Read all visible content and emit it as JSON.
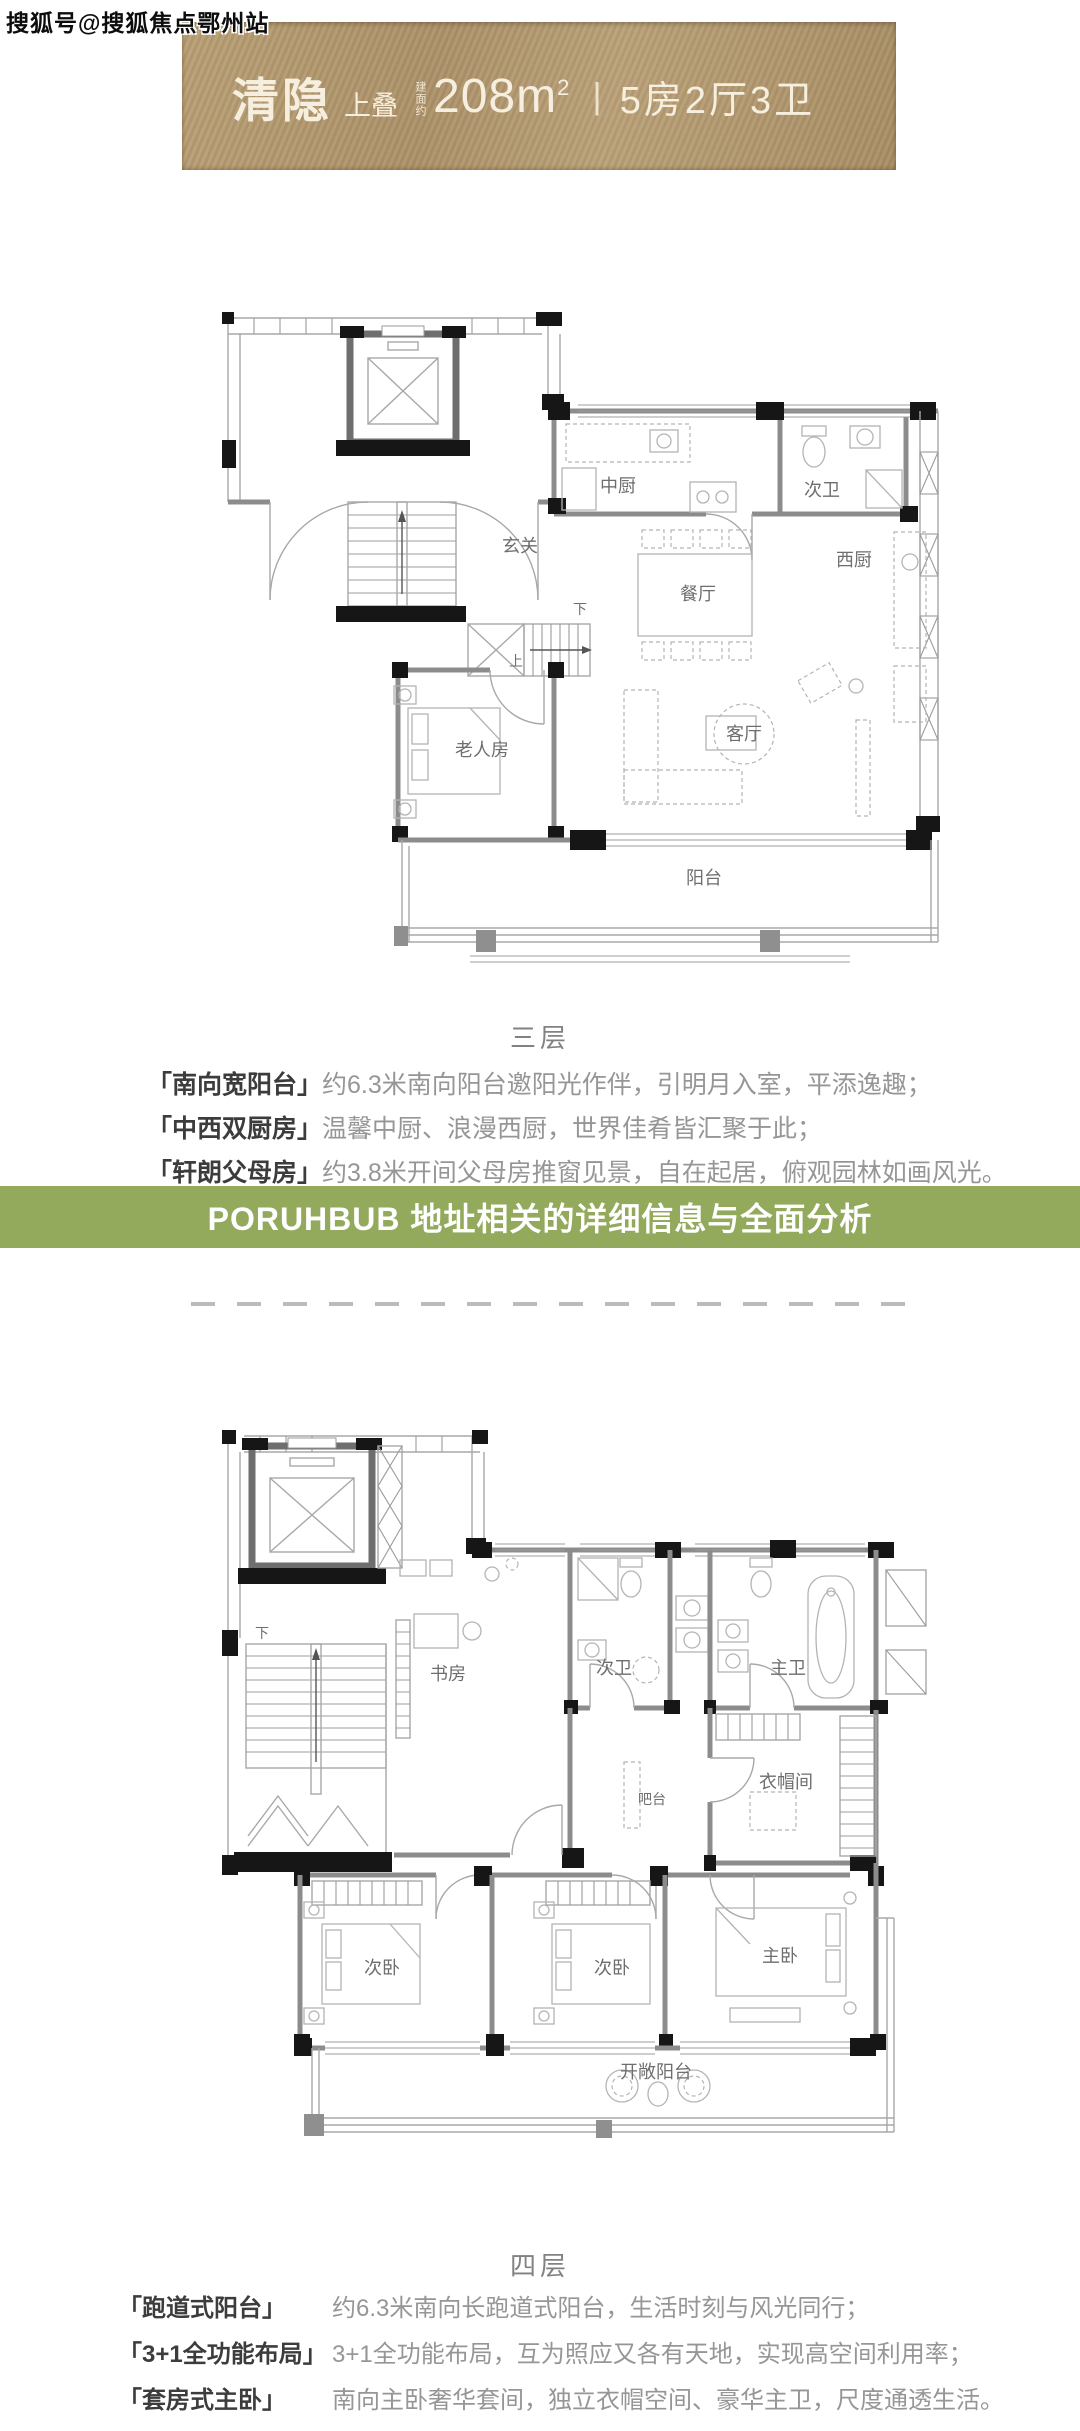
{
  "watermark": "搜狐号@搜狐焦点鄂州站",
  "banner": {
    "title": "清隐",
    "subtitle": "上叠",
    "area_label": "建面约",
    "area_value": "208m",
    "area_sup": "2",
    "separator": "|",
    "spec": "5房2厅3卫"
  },
  "colors": {
    "banner_bg": "#b0966b",
    "banner_text": "#f6efdf",
    "ad_bg": "#93a95c",
    "ad_text": "#ffffff",
    "wall_dark": "#161616",
    "caption_gray": "#828282"
  },
  "floor3": {
    "caption": "三层",
    "rooms": {
      "kitchen_cn": "中厨",
      "bath2": "次卫",
      "kitchen_w": "西厨",
      "dining": "餐厅",
      "foyer": "玄关",
      "living": "客厅",
      "elder_room": "老人房",
      "balcony": "阳台",
      "down": "下",
      "up": "上"
    },
    "features": [
      {
        "label": "「南向宽阳台」",
        "desc": "约6.3米南向阳台邀阳光作伴，引明月入室，平添逸趣；"
      },
      {
        "label": "「中西双厨房」",
        "desc": "温馨中厨、浪漫西厨，世界佳肴皆汇聚于此；"
      },
      {
        "label": "「轩朗父母房」",
        "desc": "约3.8米开间父母房推窗见景，自在起居，俯观园林如画风光。"
      }
    ]
  },
  "ad_banner": {
    "text": "PORUHBUB 地址相关的详细信息与全面分析"
  },
  "floor4": {
    "caption": "四层",
    "rooms": {
      "study": "书房",
      "bath2": "次卫",
      "bath_master": "主卫",
      "cloakroom": "衣帽间",
      "bar": "吧台",
      "bedroom2a": "次卧",
      "bedroom2b": "次卧",
      "bedroom_master": "主卧",
      "balcony": "开敞阳台",
      "down": "下"
    },
    "features": [
      {
        "label": "「跑道式阳台」",
        "desc": "约6.3米南向长跑道式阳台，生活时刻与风光同行；"
      },
      {
        "label": "「3+1全功能布局」",
        "desc": "3+1全功能布局，互为照应又各有天地，实现高空间利用率；"
      },
      {
        "label": "「套房式主卧」",
        "desc": "南向主卧奢华套间，独立衣帽空间、豪华主卫，尺度通透生活。"
      }
    ]
  }
}
